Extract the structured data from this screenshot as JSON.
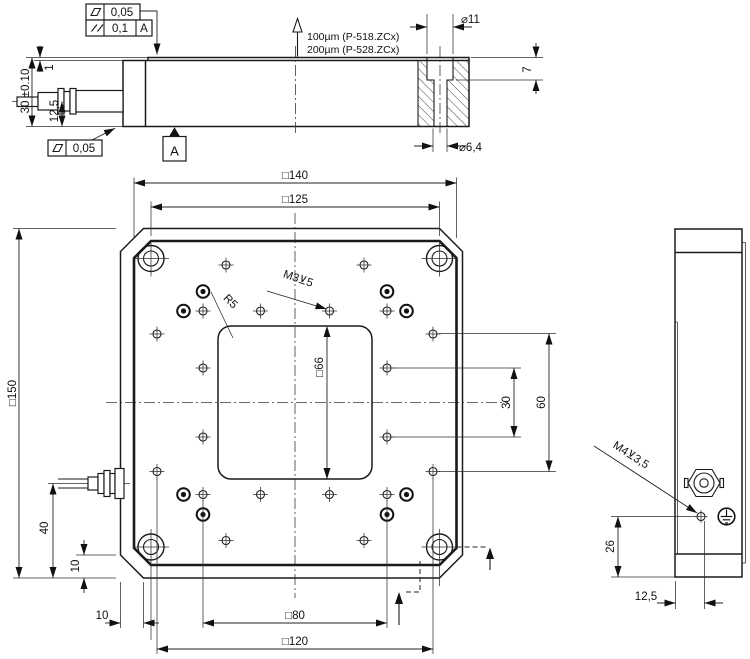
{
  "drawing": {
    "gdt": {
      "flatness_top_value": "0,05",
      "parallelism_value": "0,1",
      "parallelism_datum": "A",
      "flatness_bottom_value": "0,05",
      "datum_label": "A"
    },
    "travel_note": {
      "line1": "100µm (P-518.ZCx)",
      "line2": "200µm (P-528.ZCx)"
    },
    "front": {
      "dia_counterbore": "⌀11",
      "cb_depth": "7",
      "dia_through": "⌀6,4",
      "overall_height": "30 ±0.10",
      "plate_step": "1",
      "connector_height": "12,5"
    },
    "plan": {
      "sq_140": "□140",
      "sq_125": "□125",
      "sq_150": "□150",
      "sq_66": "□66",
      "sq_80": "□80",
      "sq_120": "□120",
      "pitch_30": "30",
      "pitch_60": "60",
      "connector_offset": "40",
      "chamfer_v": "10",
      "chamfer_h": "10",
      "thread_note": "M3⊻5",
      "corner_radius": "R5"
    },
    "side": {
      "thread_note": "M4⊻3,5",
      "hole_height": "26",
      "hole_offset": "12,5"
    }
  }
}
